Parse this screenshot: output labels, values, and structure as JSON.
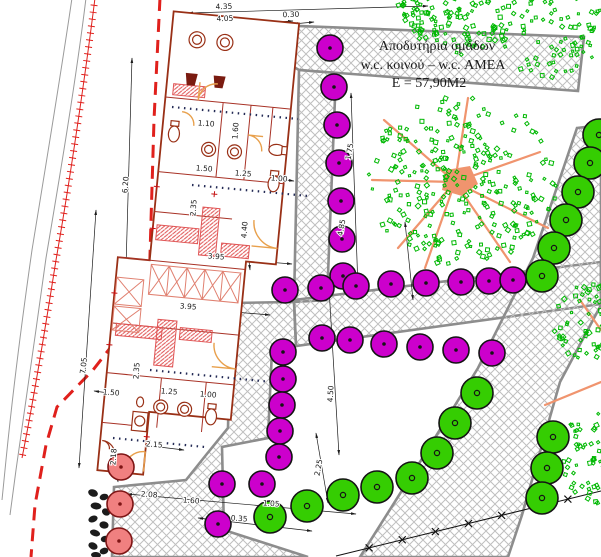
{
  "annotation": {
    "line1": "Αποδυτήρια ομάδων",
    "line2": "w.c. κοινού – w.c. ΑΜΕΑ",
    "line3": "Ε = 57,90Μ2"
  },
  "colors": {
    "accent_red": "#E0201C",
    "building_wall": "#993016",
    "benches": "#E05555",
    "door": "#E8A04C",
    "fixture_dark": "#7A1B10",
    "magenta": "#CC00CC",
    "green_fill": "#35CD02",
    "leaf": "#00B803",
    "branch": "#F0946E",
    "salmon": "#F08080",
    "hatch_line": "#BFBFBF",
    "path_edge": "#8D8D8D",
    "dim": "#1A1A1A"
  },
  "dimensions": [
    {
      "v": "4.35",
      "x": 224,
      "y": 9,
      "r": -2
    },
    {
      "v": "4.05",
      "x": 225,
      "y": 21,
      "r": -2
    },
    {
      "v": "0.30",
      "x": 291,
      "y": 17,
      "r": -2
    },
    {
      "v": "6.20",
      "x": 128,
      "y": 185,
      "r": -86
    },
    {
      "v": "7.05",
      "x": 86,
      "y": 366,
      "r": -83
    },
    {
      "v": "1.75",
      "x": 352,
      "y": 152,
      "r": -80
    },
    {
      "v": "4.85",
      "x": 344,
      "y": 228,
      "r": -80
    },
    {
      "v": "1.10",
      "x": 206,
      "y": 126,
      "r": 4
    },
    {
      "v": "1.60",
      "x": 238,
      "y": 131,
      "r": -86
    },
    {
      "v": "1.50",
      "x": 204,
      "y": 171,
      "r": 4
    },
    {
      "v": "1.25",
      "x": 243,
      "y": 176,
      "r": 4
    },
    {
      "v": "1.00",
      "x": 279,
      "y": 181,
      "r": 4
    },
    {
      "v": "2.35",
      "x": 196,
      "y": 208,
      "r": -86
    },
    {
      "v": "4.40",
      "x": 247,
      "y": 230,
      "r": -86
    },
    {
      "v": "3.95",
      "x": 216,
      "y": 259,
      "r": 4
    },
    {
      "v": "3.95",
      "x": 188,
      "y": 309,
      "r": 4
    },
    {
      "v": "2.35",
      "x": 139,
      "y": 371,
      "r": -86
    },
    {
      "v": "1.50",
      "x": 111,
      "y": 395,
      "r": 4
    },
    {
      "v": "1.25",
      "x": 169,
      "y": 394,
      "r": 4
    },
    {
      "v": "1.00",
      "x": 208,
      "y": 397,
      "r": 4
    },
    {
      "v": "2.15",
      "x": 154,
      "y": 447,
      "r": 4
    },
    {
      "v": "2.18",
      "x": 116,
      "y": 457,
      "r": -86
    },
    {
      "v": "2.08",
      "x": 149,
      "y": 497,
      "r": 4
    },
    {
      "v": "1.60",
      "x": 191,
      "y": 503,
      "r": 4
    },
    {
      "v": "1.05",
      "x": 271,
      "y": 506,
      "r": 4
    },
    {
      "v": "0.35",
      "x": 239,
      "y": 521,
      "r": 4
    },
    {
      "v": "4.50",
      "x": 333,
      "y": 394,
      "r": -87
    },
    {
      "v": "2.25",
      "x": 321,
      "y": 468,
      "r": -80
    }
  ],
  "trees": {
    "magenta": {
      "r": 13,
      "fill": "#CC00CC",
      "stroke": "#141414",
      "center": "dot",
      "pts": [
        [
          330,
          48
        ],
        [
          334,
          87
        ],
        [
          337,
          125
        ],
        [
          339,
          163
        ],
        [
          341,
          201
        ],
        [
          342,
          239
        ],
        [
          343,
          276
        ],
        [
          285,
          290
        ],
        [
          321,
          288
        ],
        [
          356,
          286
        ],
        [
          391,
          284
        ],
        [
          426,
          283
        ],
        [
          461,
          282
        ],
        [
          489,
          281
        ],
        [
          513,
          280
        ],
        [
          322,
          338
        ],
        [
          350,
          340
        ],
        [
          384,
          344
        ],
        [
          420,
          347
        ],
        [
          456,
          350
        ],
        [
          492,
          353
        ],
        [
          283,
          352
        ],
        [
          283,
          379
        ],
        [
          282,
          405
        ],
        [
          280,
          431
        ],
        [
          279,
          457
        ],
        [
          222,
          484
        ],
        [
          262,
          484
        ],
        [
          218,
          524
        ]
      ]
    },
    "green": {
      "r": 16,
      "fill": "#35CD02",
      "stroke": "#141414",
      "center": "ring",
      "pts": [
        [
          599,
          135
        ],
        [
          590,
          163
        ],
        [
          578,
          192
        ],
        [
          566,
          220
        ],
        [
          554,
          248
        ],
        [
          542,
          276
        ],
        [
          477,
          393
        ],
        [
          455,
          423
        ],
        [
          437,
          453
        ],
        [
          412,
          478
        ],
        [
          377,
          487
        ],
        [
          343,
          495
        ],
        [
          307,
          506
        ],
        [
          270,
          517
        ],
        [
          553,
          437
        ],
        [
          547,
          468
        ],
        [
          542,
          498
        ]
      ]
    },
    "salmon": {
      "r": 13,
      "fill": "#F08080",
      "stroke": "#7E1515",
      "center": "dot",
      "pts": [
        [
          121,
          467
        ],
        [
          120,
          504
        ],
        [
          119,
          541
        ]
      ]
    }
  },
  "scribble_trees": [
    {
      "cx": 455,
      "cy": 14,
      "r": 44,
      "n": 80
    },
    {
      "cx": 548,
      "cy": 26,
      "r": 56,
      "n": 110
    },
    {
      "cx": 424,
      "cy": 10,
      "r": 26,
      "n": 36
    },
    {
      "cx": 462,
      "cy": 178,
      "r": 94,
      "n": 270
    },
    {
      "cx": 594,
      "cy": 322,
      "r": 44,
      "n": 80
    },
    {
      "cx": 600,
      "cy": 456,
      "r": 50,
      "n": 85
    }
  ],
  "fence": {
    "x1": 336,
    "y1": 556,
    "x2": 601,
    "y2": 491,
    "marks": 7
  }
}
